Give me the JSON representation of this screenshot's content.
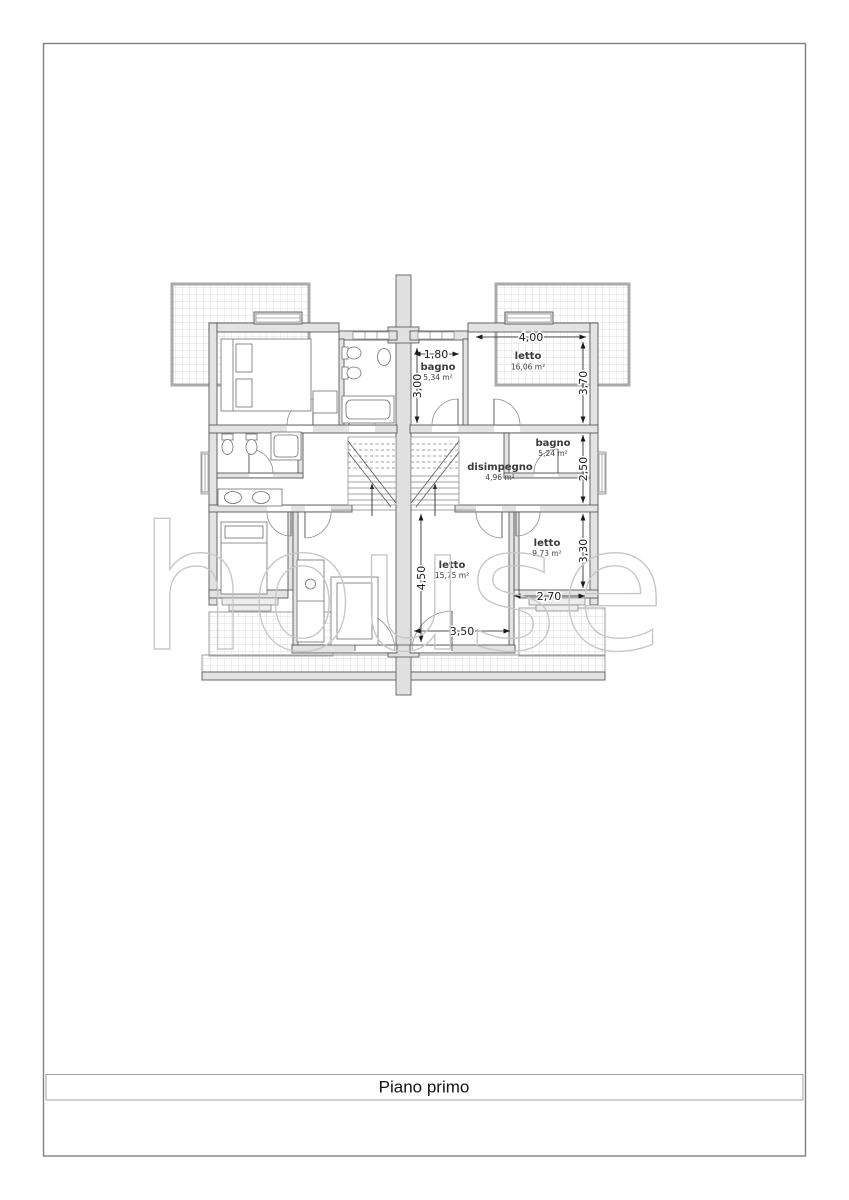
{
  "sheet": {
    "title": "Piano primo",
    "watermark": "house"
  },
  "plan": {
    "rooms": [
      {
        "name": "bagno",
        "area": "5,34 m²"
      },
      {
        "name": "letto",
        "area": "16,06 m²"
      },
      {
        "name": "bagno",
        "area": "5,24 m²"
      },
      {
        "name": "disimpegno",
        "area": "4,96 m²"
      },
      {
        "name": "letto",
        "area": "9,73 m²"
      },
      {
        "name": "letto",
        "area": "15,75 m²"
      }
    ],
    "dimensions": [
      {
        "value": "4,00",
        "axis": "horizontal"
      },
      {
        "value": "3,70",
        "axis": "vertical"
      },
      {
        "value": "1,80",
        "axis": "horizontal"
      },
      {
        "value": "3,00",
        "axis": "vertical"
      },
      {
        "value": "2,50",
        "axis": "vertical"
      },
      {
        "value": "3,30",
        "axis": "vertical"
      },
      {
        "value": "2,70",
        "axis": "horizontal"
      },
      {
        "value": "4,50",
        "axis": "vertical"
      },
      {
        "value": "3,50",
        "axis": "horizontal"
      }
    ],
    "colors": {
      "wall_fill": "#e3e3e3",
      "wall_stroke": "#58585a",
      "terrace_border": "#a9a9a9",
      "dimension_text": "#1a1a1a",
      "room_label": "#3a3a3a",
      "watermark": "#c7c7c7"
    }
  }
}
